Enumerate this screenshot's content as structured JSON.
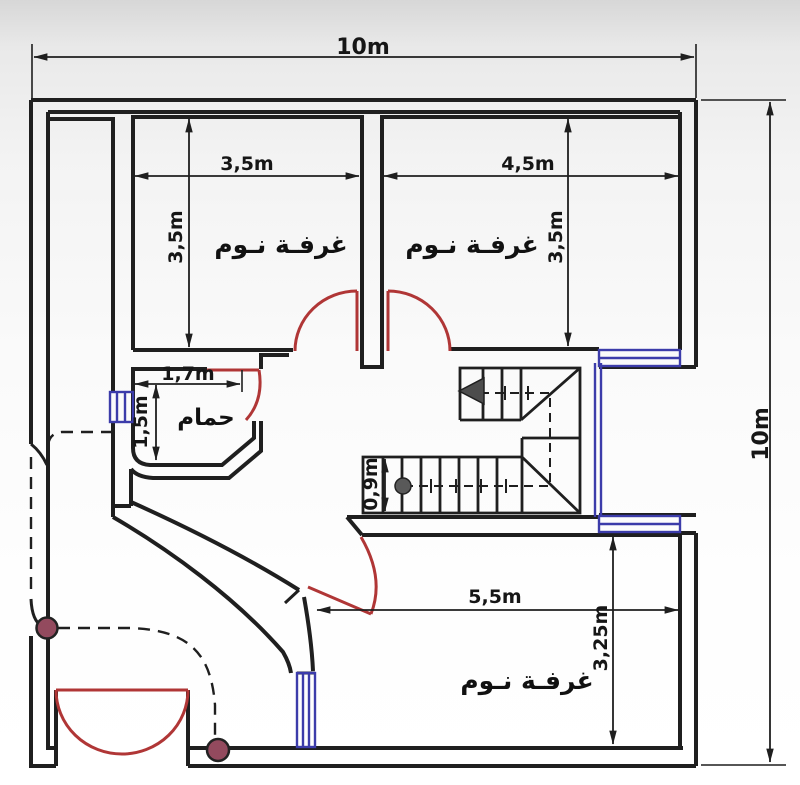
{
  "plan": {
    "type": "house-floor-plan",
    "overall": {
      "width": "10m",
      "height": "10m"
    },
    "rooms": {
      "bedroom_top_left": {
        "label": "غرفـة نـوم",
        "width": "3,5m",
        "depth": "3,5m"
      },
      "bedroom_top_right": {
        "label": "غرفـة نـوم",
        "width": "4,5m",
        "depth": "3,5m"
      },
      "bedroom_bottom": {
        "label": "غرفـة نـوم",
        "width": "5,5m",
        "depth": "3,25m"
      },
      "bathroom": {
        "label": "حمام",
        "width": "1,7m",
        "depth": "1,5m"
      },
      "staircase": {
        "flight_width": "0,9m"
      }
    },
    "colors": {
      "wall": "#1f1f1f",
      "door": "#b03636",
      "window": "#3c3caa",
      "column": "#934a5e",
      "stair_arrow": "#4d4d4d",
      "background_top": "#d7d7d7",
      "background_bottom": "#ffffff"
    }
  }
}
